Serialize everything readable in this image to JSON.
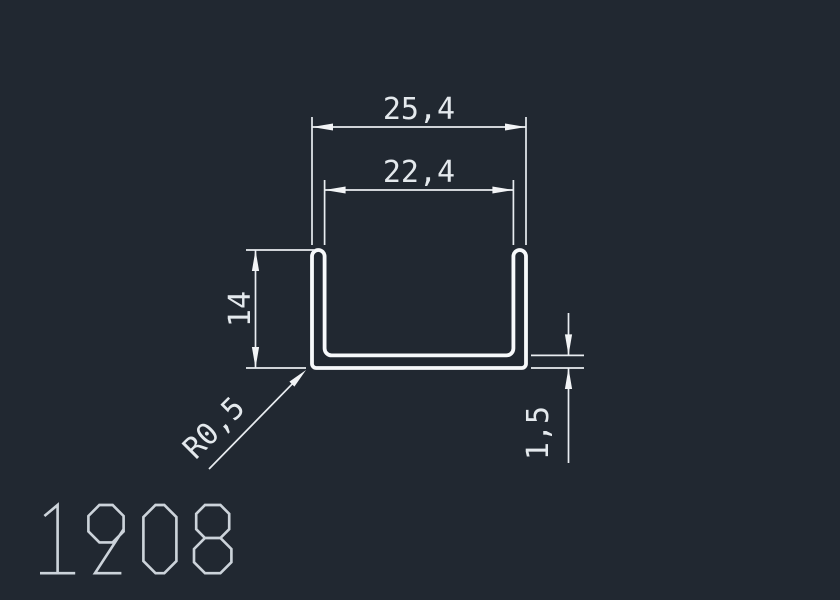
{
  "drawing": {
    "title": "1908",
    "dimensions": {
      "outer_width": "25,4",
      "inner_width": "22,4",
      "height": "14",
      "corner_radius": "R0,5",
      "thickness": "1,5"
    },
    "colors": {
      "background": "#212831",
      "dimension_lines": "#e9edf1",
      "profile_outline": "#f7f9fb",
      "title_text": "#ccd3da"
    },
    "profile_type": "u-channel"
  }
}
